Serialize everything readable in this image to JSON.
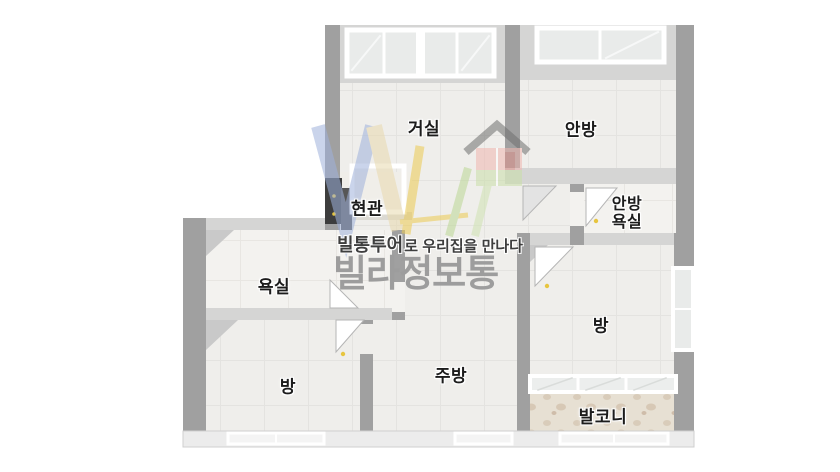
{
  "watermark": {
    "tagline_bold": "빌통투어",
    "tagline_rest": "로 우리집을 만나다",
    "brand": "빌라정보통"
  },
  "rooms": {
    "living": "거실",
    "master_bedroom": "안방",
    "entrance": "현관",
    "master_bathroom_line1": "안방",
    "master_bathroom_line2": "욕실",
    "bathroom": "욕실",
    "bedroom_left": "방",
    "kitchen": "주방",
    "bedroom_right": "방",
    "balcony": "발코니"
  },
  "colors": {
    "wall_dark": "#a0a0a0",
    "wall_light": "#d5d5d4",
    "wall_bottom_face": "#ececec",
    "floor": "#efeeeb",
    "bath_floor": "#f3f2ef",
    "balcony_floor": "#e7e0d3",
    "door_handle_yellow": "#e7c53f",
    "front_door_dark": "#474747",
    "watermark_blue": "#9fb2dc",
    "watermark_beige": "#e9d9ae",
    "watermark_yellow": "#ecca52",
    "watermark_green": "#bcd795",
    "watermark_pink": "#efb6b0",
    "brand_gray": "#9d9d9d"
  }
}
